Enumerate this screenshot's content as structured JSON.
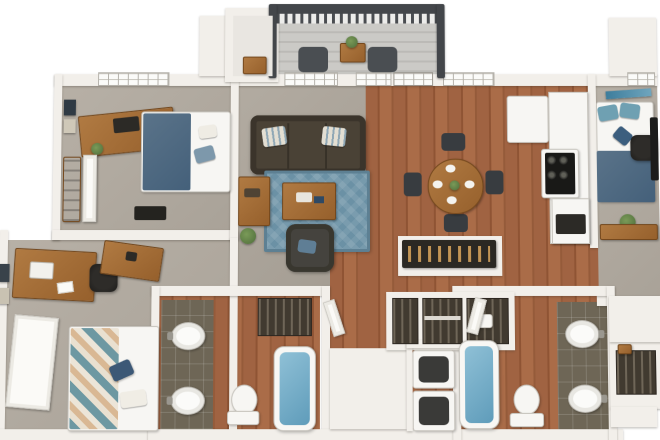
{
  "scene": {
    "description": "3D overhead rendering of a furnished multi-bedroom, multi-bath apartment floor plan on a white background",
    "view": "isometric top-down",
    "background_color": "#ffffff",
    "width_px": 660,
    "height_px": 440
  },
  "palette": {
    "wall_white": "#f2efea",
    "carpet_gray": "#b1aaa0",
    "hardwood_brown": "#9d6040",
    "bathroom_tile_olive": "#6e6656",
    "rug_blue": "#6b91a5",
    "denim_bedding_blue": "#51708a",
    "chevron_teal": "#6d98a2",
    "chevron_tan": "#d9b894",
    "sofa_brown": "#463e33",
    "tub_water_blue": "#7fb5cf",
    "deck_gray": "#c9c8c4",
    "railing_dark": "#43464a",
    "plant_green": "#5f7d4a",
    "wood_furniture": "#a8703c"
  },
  "rooms": [
    {
      "name": "balcony",
      "floor": "gray deck boards",
      "furniture": [
        "patio chair",
        "patio chair",
        "patio side table",
        "potted plant"
      ],
      "feature": "dark-railed baluster railing on three sides"
    },
    {
      "name": "storage-closet-top",
      "floor": "light",
      "furniture": [
        "storage box"
      ]
    },
    {
      "name": "bedroom-top-left",
      "floor": "carpet",
      "furniture": [
        "wood desk with monitor",
        "desk plant",
        "wall art frames",
        "bed with denim comforter and blue pillow",
        "dark floor mat",
        "closet shelving",
        "white closet door"
      ],
      "openings": [
        "window on top wall"
      ]
    },
    {
      "name": "bedroom-bottom-left",
      "floor": "carpet",
      "furniture": [
        "wood desk with laptop and papers",
        "black office chair",
        "wood dresser",
        "bed with chevron blanket and navy pillow",
        "open white panel door",
        "wall art frames"
      ]
    },
    {
      "name": "living-room",
      "floor": "carpet",
      "furniture": [
        "dark brown sofa",
        "two striped throw pillows",
        "blue patterned area rug",
        "wood coffee table with decor",
        "wood console table",
        "dark armchair with blue pillow",
        "potted plant"
      ],
      "openings": [
        "windows",
        "french door to balcony"
      ]
    },
    {
      "name": "dining-area",
      "floor": "hardwood",
      "furniture": [
        "round wood dining table",
        "four white place settings",
        "green centerpiece",
        "four dark chairs"
      ],
      "openings": [
        "two windows on top wall"
      ]
    },
    {
      "name": "kitchen",
      "floor": "hardwood",
      "furniture": [
        "white refrigerator",
        "range with black cooktop and four burners",
        "white counters",
        "microwave",
        "dark bar shelf with bottles on white peninsula"
      ]
    },
    {
      "name": "bedroom-top-right",
      "floor": "carpet",
      "furniture": [
        "blue wall art",
        "bed with two blue pillows, navy accent pillow and denim blanket",
        "black office chair",
        "dark desk",
        "potted plant",
        "low wood table"
      ],
      "openings": [
        "window on top wall"
      ]
    },
    {
      "name": "hall-closets",
      "floor": "hardwood",
      "furniture": [
        "three reach-in closet bays with shelves, hanging clothes and storage box"
      ]
    },
    {
      "name": "bathroom-left",
      "floor": "hardwood with olive tile vanity strip",
      "furniture": [
        "two white pedestal sinks",
        "toilet",
        "bathtub filled with blue water",
        "linen closet with clothes",
        "open door"
      ]
    },
    {
      "name": "laundry-closet",
      "floor": "hardwood",
      "furniture": [
        "stacked washer",
        "stacked dryer"
      ]
    },
    {
      "name": "bathroom-right",
      "floor": "hardwood with olive tile vanity strip",
      "furniture": [
        "bathtub filled with blue water",
        "toilet",
        "two white pedestal sinks",
        "open door"
      ]
    },
    {
      "name": "closet-far-right",
      "floor": "hardwood",
      "furniture": [
        "closet with hanging clothes",
        "wood ledge"
      ]
    }
  ]
}
